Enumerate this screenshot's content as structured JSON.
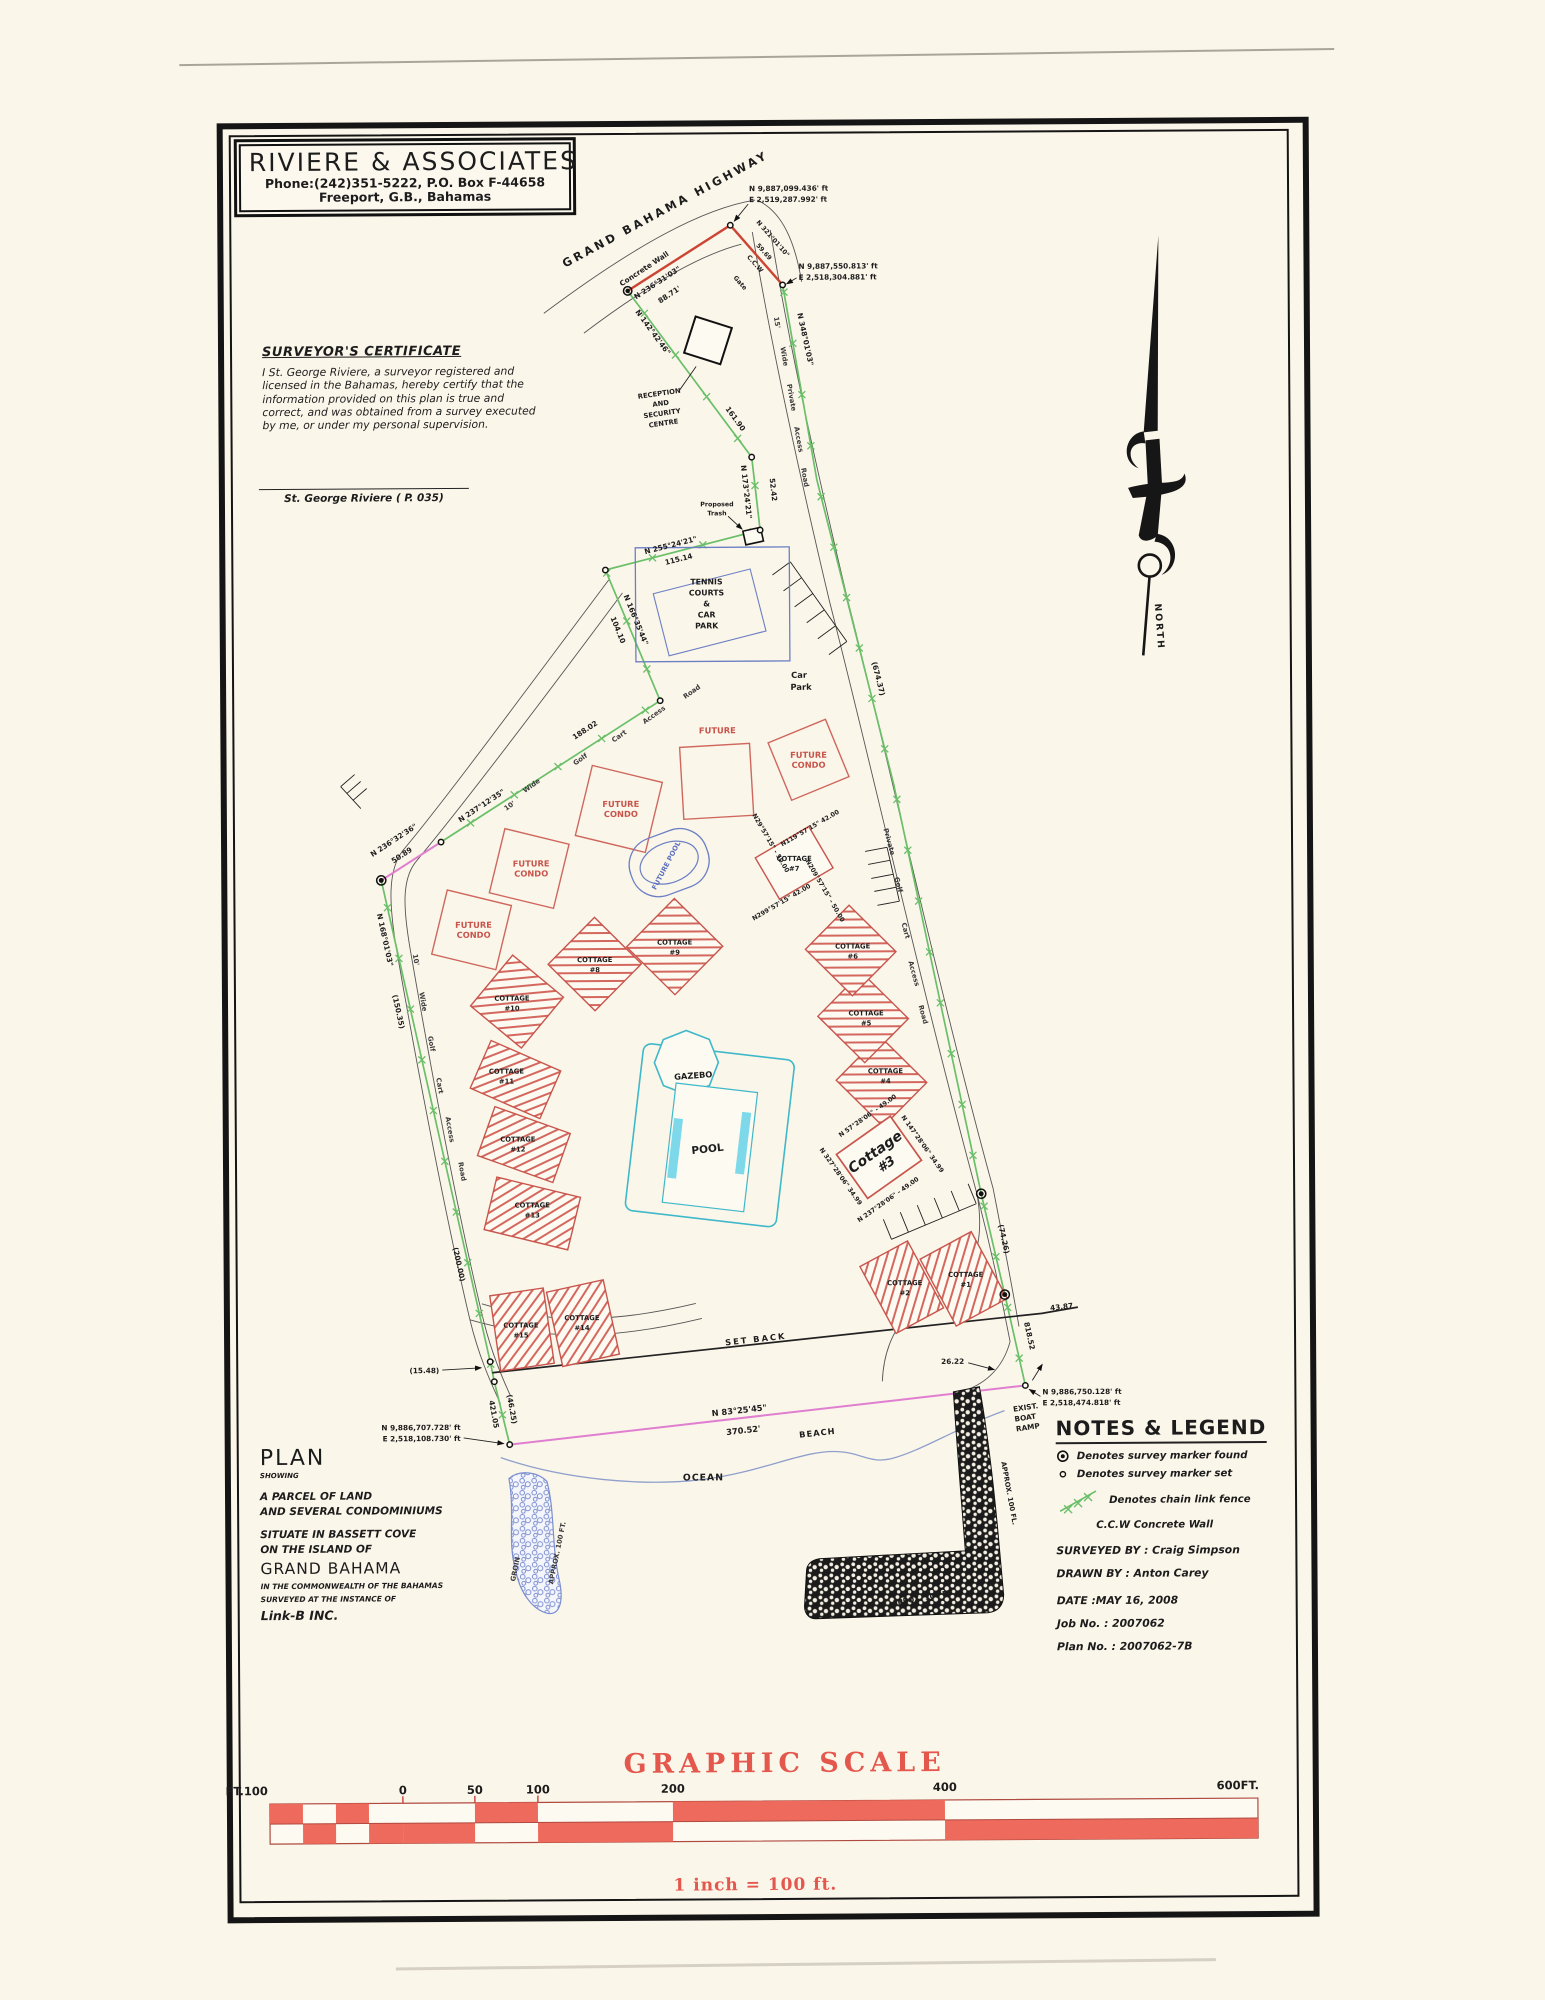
{
  "firm": {
    "name": "RIVIERE  &  ASSOCIATES",
    "phone": "Phone:(242)351-5222,    P.O. Box F-44658",
    "city": "Freeport, G.B., Bahamas"
  },
  "certificate": {
    "heading": "SURVEYOR'S CERTIFICATE",
    "lines": [
      "I St. George Riviere, a surveyor registered and",
      "licensed in the Bahamas, hereby certify that  the",
      "information provided on this plan is true and",
      "correct, and was obtained from a survey executed",
      "by me, or under my personal supervision."
    ],
    "signatory": "St. George Riviere   ( P. 035)"
  },
  "north_label": "NORTH",
  "labels": {
    "highway": "GRAND  BAHAMA  HIGHWAY",
    "concrete_wall": "Concrete Wall",
    "gate": "Gate",
    "ccw": "C.C.W",
    "reception": [
      "RECEPTION",
      "AND",
      "SECURITY",
      "CENTRE"
    ],
    "trash": [
      "Proposed",
      "Trash"
    ],
    "tennis": [
      "TENNIS",
      "COURTS",
      "&",
      "CAR",
      "PARK"
    ],
    "car_park": [
      "Car",
      "Park"
    ],
    "future_condo": [
      "FUTURE",
      "CONDO"
    ],
    "future_pool": "FUTURE POOL",
    "gazebo": "GAZEBO",
    "pool": "POOL",
    "cottage": "COTTAGE",
    "cottage3": [
      "Cottage",
      "#3"
    ],
    "set_back": "SET BACK",
    "beach": "BEACH",
    "ocean": "OCEAN",
    "boat_ramp": [
      "EXIST.",
      "BOAT",
      "RAMP"
    ],
    "groin": "GROIN",
    "groin_len": "APPROX. 100 FT.",
    "jetty_len_v": "APPROX. 100 FL.",
    "jetty_len_h": "APPOX. 100 FL.",
    "road_nw": [
      "10'",
      "Wide",
      "Golf",
      "Cart",
      "Access",
      "Road"
    ],
    "road_w": [
      "10'",
      "Wide",
      "Golf",
      "Cart",
      "Access",
      "Road"
    ],
    "road_ne": [
      "15'",
      "Wide",
      "Private",
      "Access",
      "Road"
    ],
    "road_e": [
      "Private",
      "Golf",
      "Cart",
      "Access",
      "Road"
    ]
  },
  "bearings": {
    "wall": {
      "b": "N 236°31'03\"",
      "d": "88.71'"
    },
    "gate": {
      "b": "N 321°01'10\"",
      "d": "59.69"
    },
    "ab": {
      "b": "N 142°42'46\"",
      "d": "161.90"
    },
    "bc": {
      "b": "N 173°24'21\"",
      "d": "52.42"
    },
    "cd": {
      "b": "N 255°24'21\"",
      "d": "115.14"
    },
    "de": {
      "b": "N 166°35'44\"",
      "d": "104.10"
    },
    "ef": {
      "b": "N 237°12'35\"",
      "d": "188.02"
    },
    "fg": {
      "b": "N 236°32'36\"",
      "d": "50.89"
    },
    "gh": {
      "b": "N 168°01'03\"",
      "d": "(150.35)",
      "d2": "(200.00)"
    },
    "jog": "(15.48)",
    "hj": {
      "d": "421.05",
      "d2": "(46.25)"
    },
    "beach": {
      "b": "N 83°25'45\"",
      "d": "370.52'"
    },
    "east": {
      "total": "818.52",
      "p1": "(74.26)",
      "p2": "(674.37)",
      "top": "N 348°01'03\""
    },
    "setback_end": "43.87",
    "se_tie": "26.22"
  },
  "coords": {
    "top1": [
      "N 9,887,099.436' ft",
      "E 2,519,287.992' ft"
    ],
    "top2": [
      "N 9,887,550.813' ft",
      "E 2,518,304.881' ft"
    ],
    "sw": [
      "N 9,886,707.728' ft",
      "E 2,518,108.730' ft"
    ],
    "se": [
      "N 9,886,750.128' ft",
      "E 2,518,474.818' ft"
    ]
  },
  "cottage_nums": {
    "c1": "#1",
    "c2": "#2",
    "c4": "#4",
    "c5": "#5",
    "c6": "#6",
    "c7": "#7",
    "c8": "#8",
    "c9": "#9",
    "c10": "#10",
    "c11": "#11",
    "c12": "#12",
    "c13": "#13",
    "c14": "#14",
    "c15": "#15"
  },
  "c7_bearings": [
    "N29°57'15\" - 50.00",
    "N119°57'15\"  42.00",
    "N209°57'15\" - 50.00",
    "N299°57'15\"  42.00"
  ],
  "c3_bearings": [
    "N 57°28'06\" - 49.00",
    "N 147°28'06\"  34.99",
    "N 237°28'06\" - 49.00",
    "N 327°28'06\"  34.99"
  ],
  "plan_title": {
    "plan": "PLAN",
    "showing": "SHOWING",
    "line1": "A PARCEL OF LAND",
    "line2": "AND SEVERAL CONDOMINIUMS",
    "line3": "SITUATE IN BASSETT COVE",
    "line4": "ON THE ISLAND OF",
    "island": "GRAND BAHAMA",
    "line5": "IN THE COMMONWEALTH OF THE BAHAMAS",
    "line6": "SURVEYED AT THE INSTANCE OF",
    "client": "Link-B INC."
  },
  "legend": {
    "heading": "NOTES & LEGEND",
    "marker_found": "Denotes survey marker found",
    "marker_set": "Denotes survey marker set",
    "fence": "Denotes chain link fence",
    "ccw": "C.C.W Concrete Wall",
    "surveyed": "SURVEYED BY :  Craig Simpson",
    "drawn": "DRAWN BY :  Anton Carey",
    "date": "DATE       :MAY 16, 2008",
    "job": "Job No.      :   2007062",
    "plan_no": "Plan No.     :   2007062-7B"
  },
  "scale": {
    "title": "GRAPHIC  SCALE",
    "ft_left": "FT.100",
    "t0": "0",
    "t50": "50",
    "t100": "100",
    "t200": "200",
    "t400": "400",
    "t600": "600FT.",
    "equiv": "1 inch  =  100   ft."
  }
}
